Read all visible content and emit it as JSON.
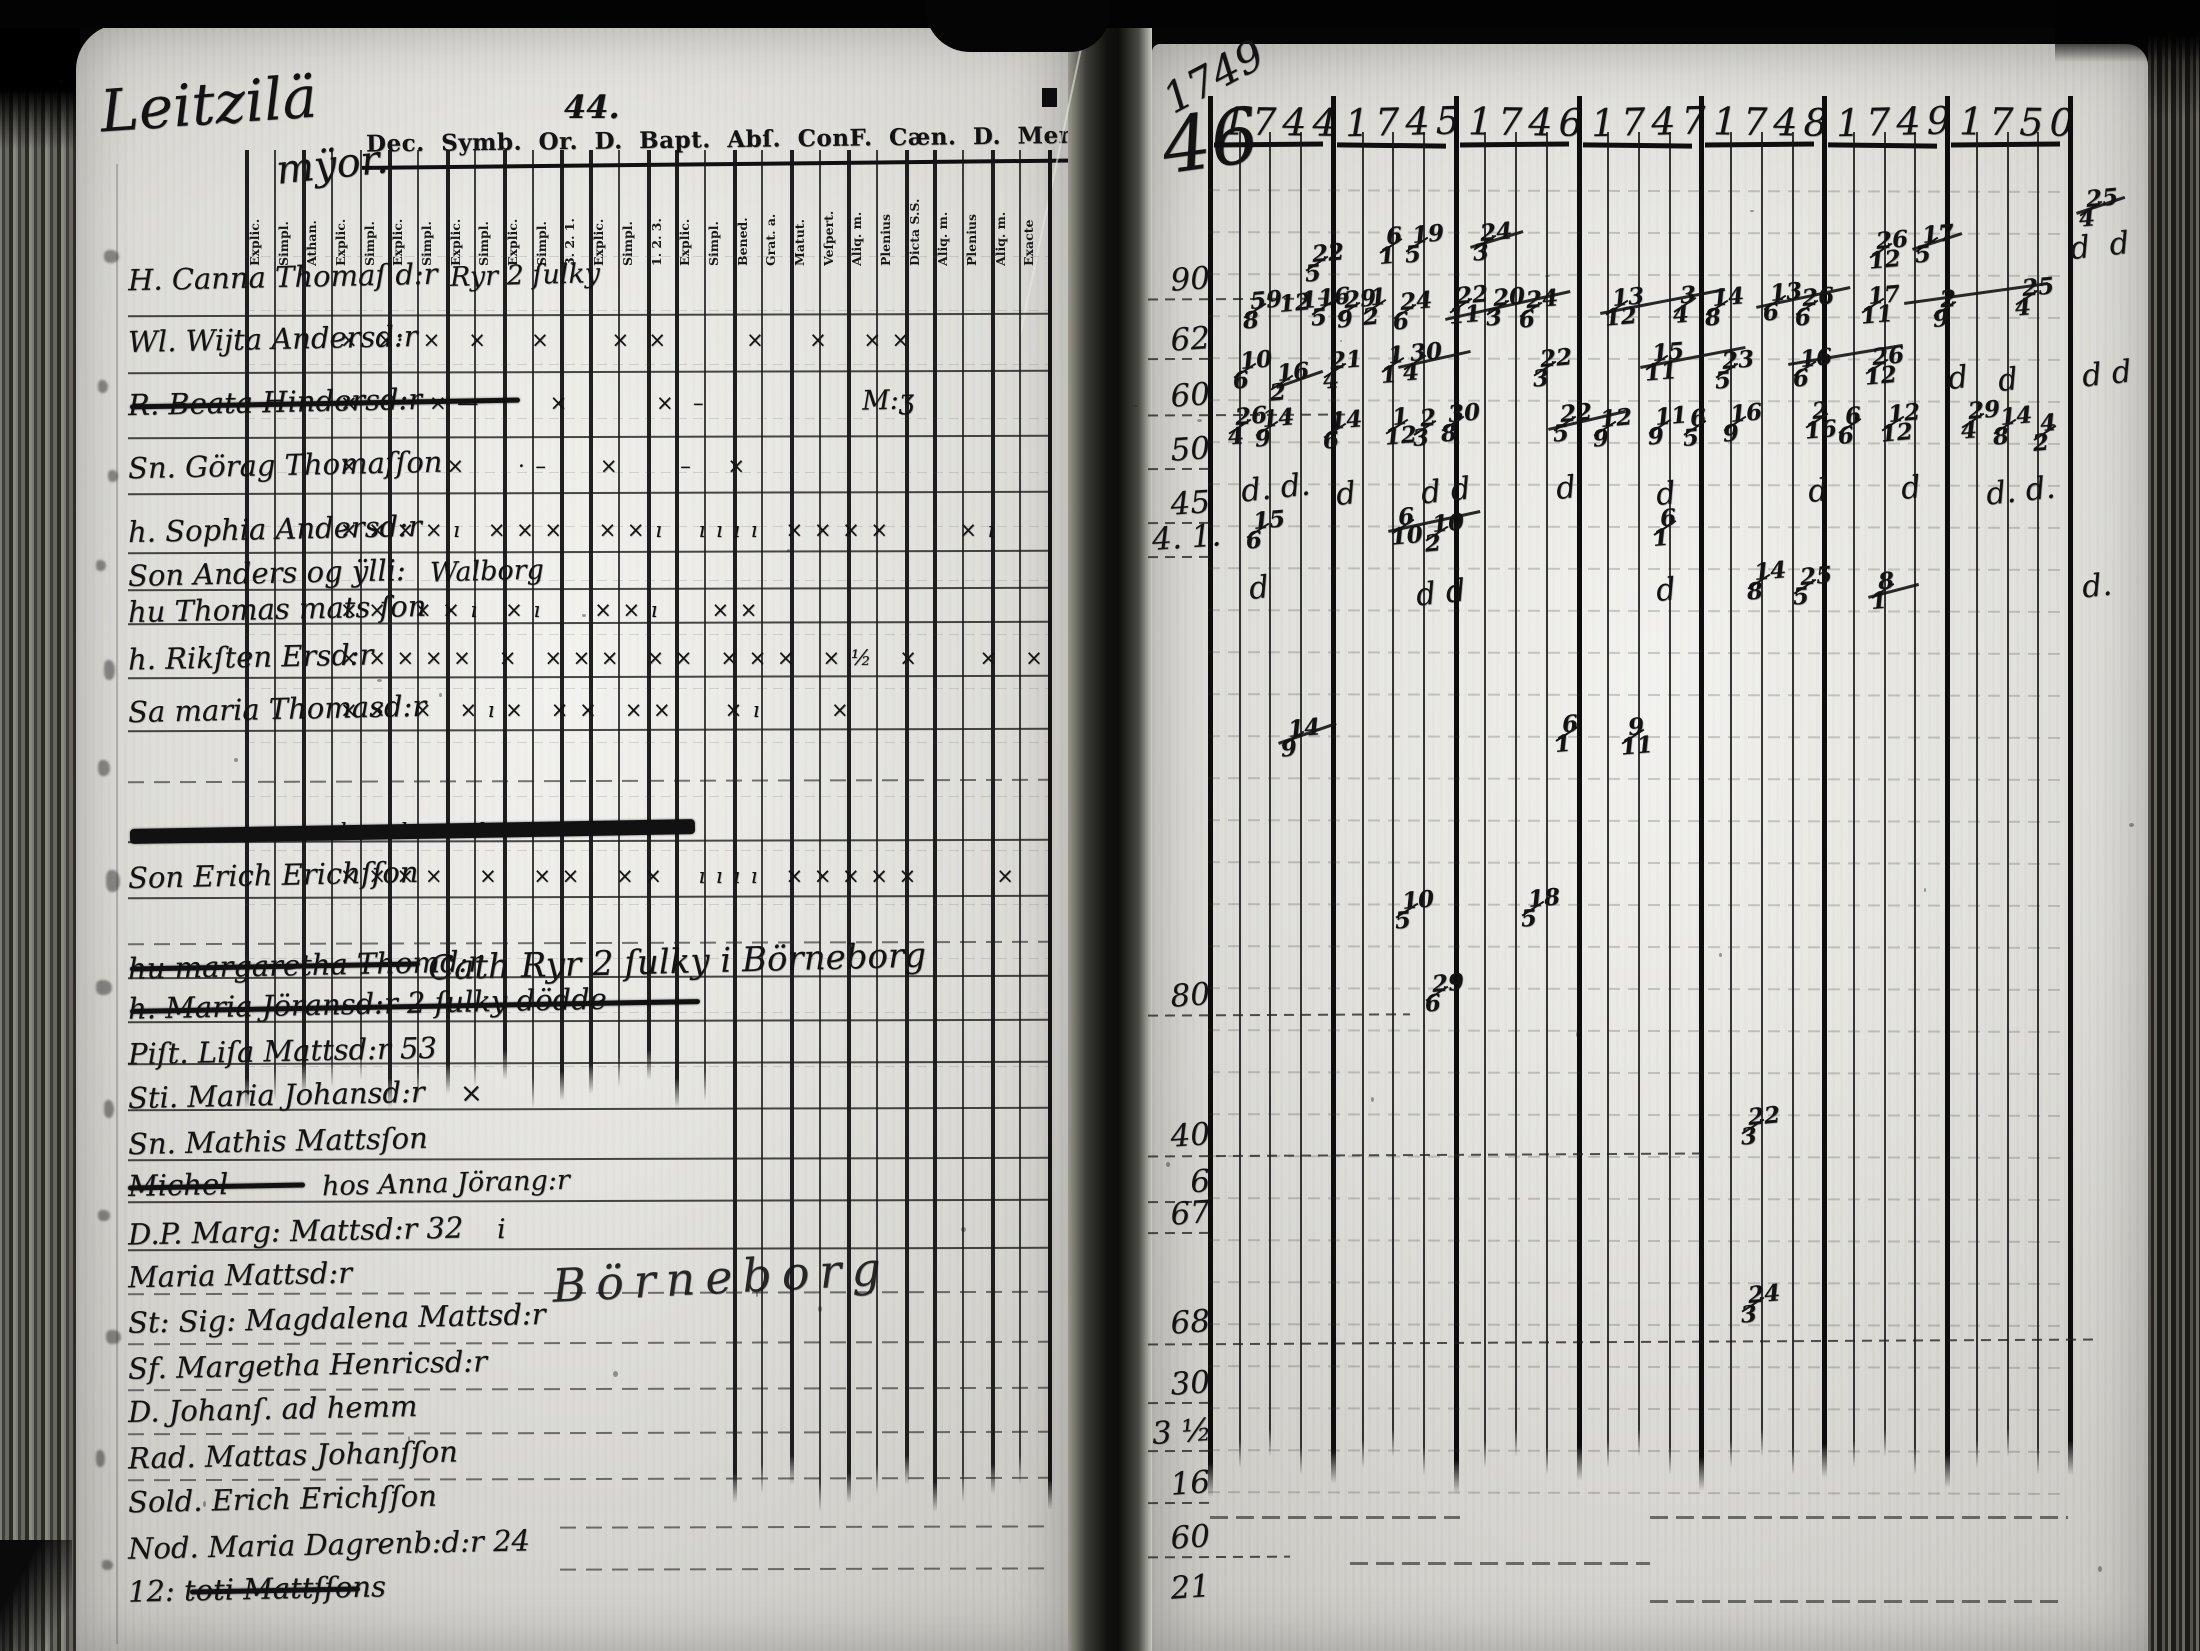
{
  "document": {
    "kind": "scanned parish communion register spread",
    "left_page": {
      "page_number": "44.",
      "title_script": "Leitzilä",
      "title_script_sub": "mÿor.",
      "printed_header": "Dec.  Symb.  Or. D.  Bapt.   Abſ. ConF. Cæn. D. Menſ. Grat.  Qvæſt. Tab. etc. L",
      "columns": [
        {
          "label": "Explic.",
          "thick": true
        },
        {
          "label": "Simpl."
        },
        {
          "label": "Athan.",
          "thick": true
        },
        {
          "label": "Explic."
        },
        {
          "label": "Simpl."
        },
        {
          "label": "Explic.",
          "thick": true
        },
        {
          "label": "Simpl."
        },
        {
          "label": "Explic.",
          "thick": true
        },
        {
          "label": "Simpl."
        },
        {
          "label": "Explic.",
          "thick": true
        },
        {
          "label": "Simpl."
        },
        {
          "label": "3. 2. 1.",
          "thick": true
        },
        {
          "label": "Explic.",
          "thick": true
        },
        {
          "label": "Simpl."
        },
        {
          "label": "1. 2. 3.",
          "thick": true
        },
        {
          "label": "Explic.",
          "thick": true
        },
        {
          "label": "Simpl."
        },
        {
          "label": "Bened.",
          "thick": true
        },
        {
          "label": "Grat. a."
        },
        {
          "label": "Matut.",
          "thick": true
        },
        {
          "label": "Veſpert."
        },
        {
          "label": "Aliq. m.",
          "thick": true
        },
        {
          "label": "Plenius"
        },
        {
          "label": "Dicta S.S.",
          "thick": true
        },
        {
          "label": "Aliq. m.",
          "thick": true
        },
        {
          "label": "Plenius"
        },
        {
          "label": "Aliq. m.",
          "thick": true
        },
        {
          "label": "Exacte"
        }
      ],
      "rows": [
        {
          "y": 260,
          "name": "H. Canna Thomaſ d:r",
          "line_y": 314,
          "ann": [
            {
              "x": 450,
              "t": "Ryr 2 ſulky"
            }
          ]
        },
        {
          "y": 322,
          "name": "Wl. Wijta Andersd:r",
          "line_y": 371,
          "marks": "×  ×·  ×   ×     ×       ×  ×         ×     ×    × ×"
        },
        {
          "y": 385,
          "name": "R. Beata Hindersd:r",
          "line_y": 436,
          "struck": [
            130,
            520
          ],
          "marks": "×        × —        ×          ×  –",
          "ann": [
            {
              "x": 862,
              "t": "M:ʒ"
            }
          ]
        },
        {
          "y": 448,
          "name": "Sn. Görag Thomaſſon",
          "line_y": 492,
          "marks": "×          ×      · –      ×       –    ×"
        },
        {
          "y": 512,
          "name": "h. Sophia Andersd:r",
          "line_y": 551,
          "marks": "× × × × ı   × × ×    × × ı    ı ı ı ı   × × × ×        × ı"
        },
        {
          "y": 556,
          "name": "Son Anders og ÿlli:",
          "line_y": 588,
          "ann": [
            {
              "x": 430,
              "t": "Walborg"
            }
          ]
        },
        {
          "y": 592,
          "name": "hu Thomas mats ſon",
          "line_y": 622,
          "marks": "× ×   × × ı   × ı      × × ı      × ×"
        },
        {
          "y": 640,
          "name": "h. Rikſten Ersd:r",
          "line_y": 676,
          "marks": "× × × × ×   ×   × × ×   × ×   × × ×   × ½   ×       ×   × ×"
        },
        {
          "y": 692,
          "name": "Sa maria Thomasd:r",
          "line_y": 729,
          "marks": "× ×   ×   × ı ×   × ×   × ×      × ı        ×"
        },
        {
          "y": 0,
          "name": "",
          "line_y": 780,
          "dashed": true
        },
        {
          "y": 808,
          "name": "",
          "line_y": 840,
          "struck": [
            130,
            695
          ],
          "heavy": true,
          "marks": "ı      ı        ı"
        },
        {
          "y": 858,
          "name": "Son Erich Erichſſon",
          "line_y": 896,
          "marks": "× × × ×    ×    × ×    × ×    ı ı ı ı   × × × × ×         ×"
        },
        {
          "y": 0,
          "name": "",
          "line_y": 942,
          "dashed": true
        },
        {
          "y": 948,
          "name": "hu margaretha Thomd:r",
          "line_y": 976,
          "struck": [
            130,
            420
          ],
          "ann": [
            {
              "x": 428,
              "t": "Cath Ryr 2 ſulky i Börneborg",
              "big": true
            }
          ]
        },
        {
          "y": 988,
          "name": "h. Maria Jöransd:r      2 ſulky     dödde",
          "line_y": 1020,
          "struck": [
            130,
            700
          ]
        },
        {
          "y": 1034,
          "name": "Piſt. Liſa Mattsd:r 53",
          "line_y": 1062
        },
        {
          "y": 1078,
          "name": "Sti. Maria Johansd:r",
          "line_y": 1108,
          "ann": [
            {
              "x": 460,
              "t": "×"
            }
          ]
        },
        {
          "y": 1124,
          "name": "Sn. Mathis Mattsſon",
          "line_y": 1158
        },
        {
          "y": 1168,
          "name": "Michel",
          "line_y": 1200,
          "struck": [
            128,
            305
          ],
          "ann": [
            {
              "x": 322,
              "t": "hos Anna Jörang:r"
            }
          ]
        },
        {
          "y": 1214,
          "name": "D.P. Marg: Mattsd:r 32",
          "line_y": 1248,
          "ann": [
            {
              "x": 497,
              "t": "i"
            }
          ]
        },
        {
          "y": 1258,
          "name": "Maria Mattsd:r",
          "line_y": 1292,
          "dashed": true
        },
        {
          "y": 1302,
          "name": "St: Sig: Magdalena Mattsd:r",
          "line_y": 1342,
          "dashed": true
        },
        {
          "y": 1348,
          "name": "Sf. Margetha Henricsd:r",
          "line_y": 1388,
          "dashed": true
        },
        {
          "y": 1392,
          "name": "D. Johanſ. ad hemm",
          "line_y": 1432,
          "dashed": true
        },
        {
          "y": 1438,
          "name": "Rad. Mattas Johanſſon",
          "line_y": 1478,
          "dashed": true
        },
        {
          "y": 1482,
          "name": "Sold. Erich Erichſſon",
          "line_y": 1526,
          "dashed": true,
          "line_x1": 560
        },
        {
          "y": 1528,
          "name": "Nod. Maria Dagrenb:d:r 24",
          "line_y": 1568,
          "dashed": true,
          "line_x1": 560
        },
        {
          "y": 1572,
          "name": "12: toti Mattſſons",
          "struck": [
            190,
            360
          ]
        }
      ],
      "flourish": {
        "text": "Börneborg",
        "x": 552,
        "y": 1250
      }
    },
    "right_page": {
      "corner_year": "1749",
      "corner_number": "46",
      "years": [
        "1744",
        "1745",
        "1746",
        "1747",
        "1748",
        "1749",
        "1750"
      ],
      "margin_labels": [
        {
          "text": "90",
          "y": 262,
          "line_to": 1345
        },
        {
          "text": "62",
          "y": 322,
          "line_to": 1212
        },
        {
          "text": "60",
          "y": 378,
          "line_to": 1345
        },
        {
          "text": "50",
          "y": 432,
          "line_to": 1212
        },
        {
          "text": "45",
          "y": 486,
          "line_to": 1212
        },
        {
          "text": "4. 1.",
          "y": 520,
          "line_to": 1212
        },
        {
          "text": "80",
          "y": 978,
          "line_to": 1410
        },
        {
          "text": "40",
          "y": 1118,
          "line_to": 1700
        },
        {
          "text": "6",
          "y": 1165,
          "line_to": 1212
        },
        {
          "text": "67",
          "y": 1196,
          "line_to": 1212
        },
        {
          "text": "68",
          "y": 1305,
          "line_to": 2100
        },
        {
          "text": "30",
          "y": 1366,
          "line_to": 1212
        },
        {
          "text": "3 ½",
          "y": 1414,
          "line_to": 1212
        },
        {
          "text": "16",
          "y": 1466,
          "line_to": 1212
        },
        {
          "text": "60",
          "y": 1520,
          "line_to": 1290
        },
        {
          "text": "21",
          "y": 1570,
          "line_to": 0
        }
      ],
      "entries": [
        {
          "x": 1308,
          "y": 245,
          "t": "22/5"
        },
        {
          "x": 1382,
          "y": 228,
          "t": "6/1"
        },
        {
          "x": 1408,
          "y": 226,
          "t": "19/5"
        },
        {
          "x": 1476,
          "y": 224,
          "t": "24/3"
        },
        {
          "x": 1872,
          "y": 232,
          "t": "26/12"
        },
        {
          "x": 1918,
          "y": 226,
          "t": "17/5"
        },
        {
          "x": 1246,
          "y": 292,
          "t": "59/8"
        },
        {
          "x": 1274,
          "y": 295,
          "t": "12"
        },
        {
          "x": 1296,
          "y": 292,
          "t": "1"
        },
        {
          "x": 1314,
          "y": 289,
          "t": "16/5"
        },
        {
          "x": 1340,
          "y": 291,
          "t": "29/9"
        },
        {
          "x": 1366,
          "y": 289,
          "t": "1/2"
        },
        {
          "x": 1396,
          "y": 293,
          "t": "24/6"
        },
        {
          "x": 1452,
          "y": 287,
          "t": "22/11"
        },
        {
          "x": 1489,
          "y": 289,
          "t": "20/3"
        },
        {
          "x": 1522,
          "y": 291,
          "t": "24/6"
        },
        {
          "x": 1608,
          "y": 289,
          "t": "13/12"
        },
        {
          "x": 1676,
          "y": 287,
          "t": "3/4"
        },
        {
          "x": 1708,
          "y": 289,
          "t": "14/8"
        },
        {
          "x": 1766,
          "y": 284,
          "t": "13/6"
        },
        {
          "x": 1798,
          "y": 289,
          "t": "26/6"
        },
        {
          "x": 1864,
          "y": 287,
          "t": "17/11"
        },
        {
          "x": 1936,
          "y": 291,
          "t": "2/9"
        },
        {
          "x": 2018,
          "y": 279,
          "t": "25/4"
        },
        {
          "x": 2082,
          "y": 190,
          "t": "25/4"
        },
        {
          "x": 2070,
          "y": 228,
          "t": "d  d",
          "script": true
        },
        {
          "x": 1236,
          "y": 352,
          "t": "10/6"
        },
        {
          "x": 1273,
          "y": 364,
          "t": "16/2"
        },
        {
          "x": 1326,
          "y": 352,
          "t": "21/4"
        },
        {
          "x": 1384,
          "y": 347,
          "t": "1/1"
        },
        {
          "x": 1406,
          "y": 344,
          "t": "30/4"
        },
        {
          "x": 1536,
          "y": 350,
          "t": "22/3"
        },
        {
          "x": 1648,
          "y": 344,
          "t": "15/11"
        },
        {
          "x": 1718,
          "y": 352,
          "t": "23/5"
        },
        {
          "x": 1796,
          "y": 350,
          "t": "16/6"
        },
        {
          "x": 1868,
          "y": 348,
          "t": "26/12"
        },
        {
          "x": 1948,
          "y": 360,
          "t": "d",
          "script": true
        },
        {
          "x": 1998,
          "y": 362,
          "t": "d",
          "script": true
        },
        {
          "x": 2082,
          "y": 356,
          "t": "d d",
          "script": true
        },
        {
          "x": 1231,
          "y": 408,
          "t": "26/4"
        },
        {
          "x": 1258,
          "y": 410,
          "t": "14/9"
        },
        {
          "x": 1326,
          "y": 412,
          "t": "14/6"
        },
        {
          "x": 1388,
          "y": 408,
          "t": "1/12"
        },
        {
          "x": 1416,
          "y": 410,
          "t": "2/3"
        },
        {
          "x": 1444,
          "y": 405,
          "t": "30/8"
        },
        {
          "x": 1556,
          "y": 405,
          "t": "22/5"
        },
        {
          "x": 1596,
          "y": 410,
          "t": "12/9"
        },
        {
          "x": 1651,
          "y": 408,
          "t": "11/9"
        },
        {
          "x": 1686,
          "y": 410,
          "t": "6/5"
        },
        {
          "x": 1726,
          "y": 405,
          "t": "16/9"
        },
        {
          "x": 1808,
          "y": 402,
          "t": "2/16"
        },
        {
          "x": 1841,
          "y": 408,
          "t": "6/6"
        },
        {
          "x": 1884,
          "y": 405,
          "t": "12/12"
        },
        {
          "x": 1964,
          "y": 402,
          "t": "29/4"
        },
        {
          "x": 1996,
          "y": 408,
          "t": "14/8"
        },
        {
          "x": 2036,
          "y": 415,
          "t": "4/2"
        },
        {
          "x": 1241,
          "y": 470,
          "t": "d. d.",
          "script": true
        },
        {
          "x": 1336,
          "y": 476,
          "t": "d",
          "script": true
        },
        {
          "x": 1421,
          "y": 473,
          "t": "d d",
          "script": true
        },
        {
          "x": 1556,
          "y": 470,
          "t": "d",
          "script": true
        },
        {
          "x": 1656,
          "y": 476,
          "t": "d",
          "script": true
        },
        {
          "x": 1808,
          "y": 473,
          "t": "d",
          "script": true
        },
        {
          "x": 1901,
          "y": 470,
          "t": "d",
          "script": true
        },
        {
          "x": 1986,
          "y": 473,
          "t": "d. d.",
          "script": true
        },
        {
          "x": 1249,
          "y": 512,
          "t": "15/6"
        },
        {
          "x": 1394,
          "y": 508,
          "t": "6/10"
        },
        {
          "x": 1428,
          "y": 515,
          "t": "10/2"
        },
        {
          "x": 1656,
          "y": 510,
          "t": "6/1"
        },
        {
          "x": 1249,
          "y": 570,
          "t": "d",
          "script": true
        },
        {
          "x": 1416,
          "y": 575,
          "t": "d d",
          "script": true
        },
        {
          "x": 1656,
          "y": 572,
          "t": "d",
          "script": true
        },
        {
          "x": 1750,
          "y": 563,
          "t": "14/8"
        },
        {
          "x": 1796,
          "y": 568,
          "t": "25/5"
        },
        {
          "x": 1874,
          "y": 573,
          "t": "8/1"
        },
        {
          "x": 2082,
          "y": 568,
          "t": "d.",
          "script": true
        },
        {
          "x": 1284,
          "y": 720,
          "t": "14/9"
        },
        {
          "x": 1558,
          "y": 716,
          "t": "6/1"
        },
        {
          "x": 1624,
          "y": 718,
          "t": "9/11"
        },
        {
          "x": 1398,
          "y": 892,
          "t": "10/5"
        },
        {
          "x": 1524,
          "y": 890,
          "t": "18/5"
        },
        {
          "x": 1428,
          "y": 975,
          "t": "29/6"
        },
        {
          "x": 1744,
          "y": 1108,
          "t": "22/3"
        },
        {
          "x": 1744,
          "y": 1286,
          "t": "24/3"
        }
      ],
      "strikes": [
        [
          1445,
          318,
          1570,
          290
        ],
        [
          1600,
          312,
          1725,
          288
        ],
        [
          1756,
          306,
          1850,
          286
        ],
        [
          1276,
          386,
          1322,
          370
        ],
        [
          1398,
          366,
          1470,
          350
        ],
        [
          1640,
          366,
          1745,
          346
        ],
        [
          1788,
          363,
          1902,
          344
        ],
        [
          1548,
          428,
          1625,
          410
        ],
        [
          1388,
          530,
          1480,
          510
        ],
        [
          1868,
          596,
          1918,
          583
        ],
        [
          1278,
          742,
          1336,
          722
        ],
        [
          1470,
          246,
          1523,
          230
        ],
        [
          1912,
          248,
          1962,
          232
        ],
        [
          2076,
          212,
          2124,
          196
        ],
        [
          1904,
          302,
          2048,
          282
        ]
      ]
    }
  }
}
